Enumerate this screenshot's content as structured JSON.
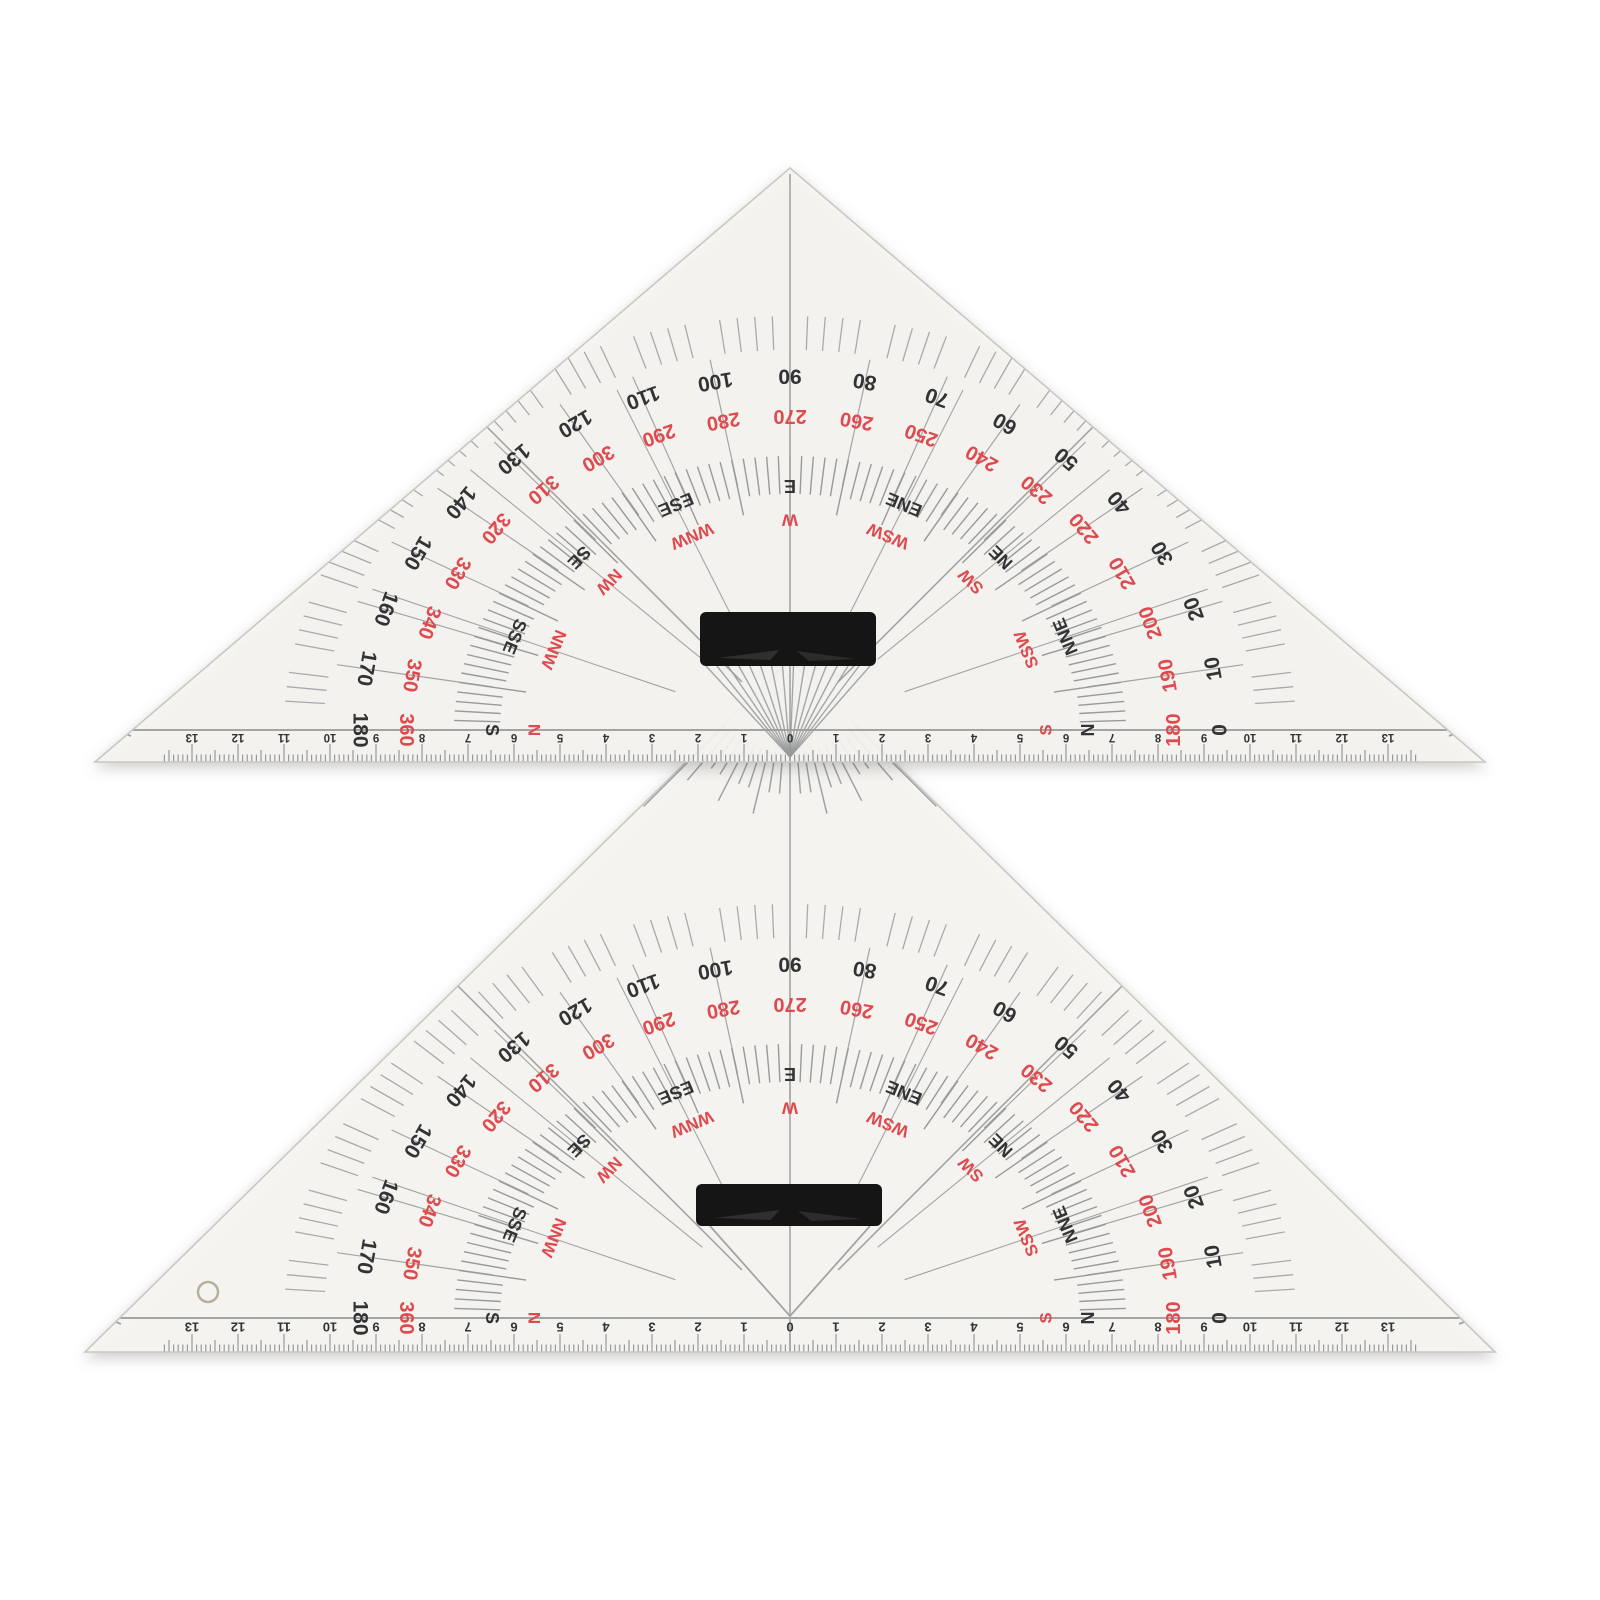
{
  "scene": {
    "description": "Two transparent nautical course plotting protractor triangles with black grip handles",
    "background": "#ffffff"
  },
  "colors": {
    "body": "#f6f5f2",
    "body_edge": "#c9c8c4",
    "tick": "#97999a",
    "tick_light": "#a8aaab",
    "line": "#a3a5a4",
    "number_black": "#333335",
    "number_red": "#de4a4e",
    "handle": "#151515",
    "handle_sheen": "#4a4a4a",
    "hole_ring": "#b7b09c",
    "shadow": "rgba(40,40,40,0.25)"
  },
  "protractor": {
    "degrees_black": [
      "0",
      "10",
      "20",
      "30",
      "40",
      "50",
      "60",
      "70",
      "80",
      "90",
      "100",
      "110",
      "120",
      "130",
      "140",
      "150",
      "160",
      "170",
      "180"
    ],
    "degrees_red": [
      "180",
      "190",
      "200",
      "210",
      "220",
      "230",
      "240",
      "250",
      "260",
      "270",
      "280",
      "290",
      "300",
      "310",
      "320",
      "330",
      "340",
      "350",
      "360"
    ],
    "compass_black": [
      "N",
      "NNE",
      "NE",
      "ENE",
      "E",
      "ESE",
      "SE",
      "SSE",
      "S"
    ],
    "compass_red": [
      "S",
      "SSW",
      "SW",
      "WSW",
      "W",
      "WNW",
      "NW",
      "NNW",
      "N"
    ]
  },
  "ruler": {
    "center_label": "0",
    "side_labels": [
      "1",
      "2",
      "3",
      "4",
      "5",
      "6",
      "7",
      "8",
      "9",
      "10",
      "11",
      "12",
      "13"
    ]
  },
  "triangles": [
    {
      "id": "plotting-triangle-rear"
    },
    {
      "id": "plotting-triangle-front"
    }
  ]
}
